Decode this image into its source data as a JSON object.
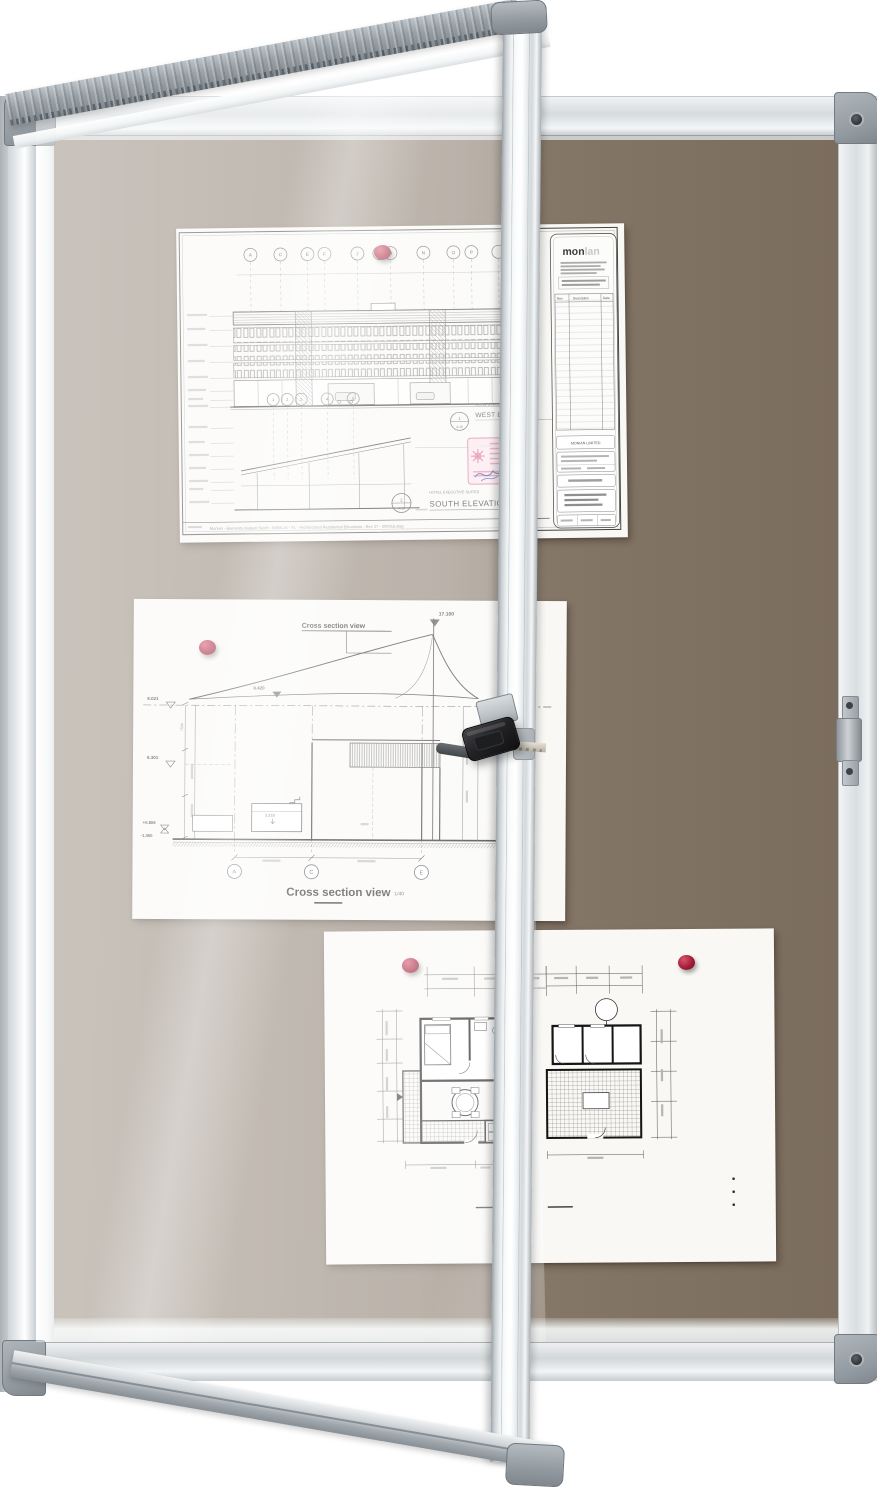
{
  "scene": {
    "description": "Lockable notice board with open glazed door, architectural drawings pinned with red push pins and keys in the lock",
    "colors": {
      "felt": "#8b7d6e",
      "felt_through_glass": "#a79e94",
      "frame_aluminum": "#e9edef",
      "corner_cap_gray": "#9aa1a6",
      "pin_red": "#a41d36",
      "key_fob_black": "#191919",
      "key_blade": "#d6d0c2",
      "paper_white": "#f9f8f5"
    }
  },
  "elevation_sheet": {
    "grid_letters": [
      "A",
      "C",
      "E",
      "F",
      "J",
      "M",
      "N",
      "O",
      "P"
    ],
    "section_grid_numbers": [
      "1",
      "2",
      "3",
      "4",
      "5"
    ],
    "subtitle_small": "HOTEL EXECUTIVE SUITES",
    "title_west": "WEST ELEVATION",
    "title_south": "SOUTH ELEVATION",
    "detail_circle_west": {
      "top": "1",
      "bottom": "A-10"
    },
    "detail_circle_south": {
      "top": "2",
      "bottom": "A-10"
    },
    "logo_bold": "mon",
    "logo_light": "lan",
    "client": "MONIAN LIMITED",
    "rev_table": {
      "col_rev": "Rev",
      "col_description": "Description",
      "col_date": "Date"
    },
    "footer": "Monian - Elements Malyan South - B4WL16 - St. - Architectural Residential Elevations - Rev 27 - 200316.dwg"
  },
  "section_sheet": {
    "annotation": "Cross section view",
    "title": "Cross section view",
    "scale": "1/40",
    "level_top": "17.100",
    "level_ridge": "8.420",
    "level_eaves": "8.021",
    "level_mid": "6.301",
    "level_ground": "+0.806",
    "level_below": "-1.350",
    "label_inner": "3.318",
    "dim_left": "7500",
    "grid_letters": [
      "A",
      "C",
      "E"
    ]
  }
}
